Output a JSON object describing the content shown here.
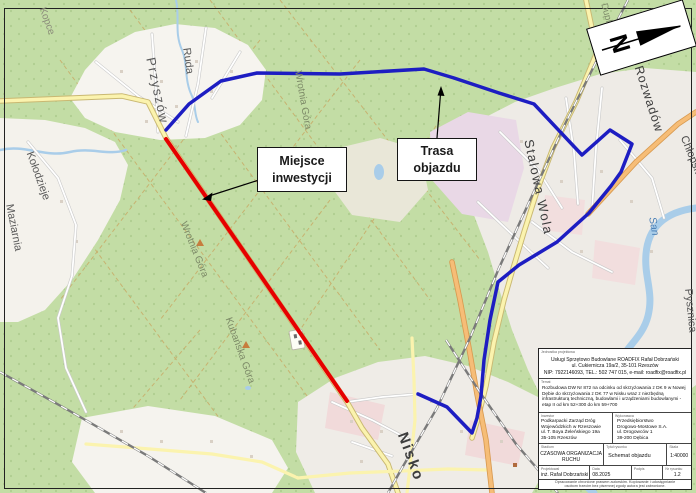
{
  "colors": {
    "investment_line": "#e60000",
    "detour_line": "#1d1dc2",
    "forest": "#c3dda5",
    "water": "#a9cde9",
    "road_yellow": "#fbf3ae",
    "road_orange": "#f6bd77",
    "callout_border": "#151515"
  },
  "callouts": {
    "investment_label": "Miejsce inwestycji",
    "detour_label": "Trasa objazdu"
  },
  "compass": {
    "north_letter": "N"
  },
  "map_labels": [
    {
      "name": "przyszow",
      "text": "Przyszów"
    },
    {
      "name": "ruda",
      "text": "Ruda"
    },
    {
      "name": "kopce",
      "text": "Kopce"
    },
    {
      "name": "kolodzieje",
      "text": "Kołodzieje"
    },
    {
      "name": "maziarnia",
      "text": "Maziarnia"
    },
    {
      "name": "wrotnia-gora-north",
      "text": "Wrotnia Góra"
    },
    {
      "name": "wrotnia-gora",
      "text": "Wrotnia Góra"
    },
    {
      "name": "kubanska-gora",
      "text": "Kubańska Góra"
    },
    {
      "name": "stalowa-wola",
      "text": "Stalowa Wola"
    },
    {
      "name": "rozwadow",
      "text": "Rozwadów"
    },
    {
      "name": "chlopska-wola",
      "text": "Chłopska Wola"
    },
    {
      "name": "pysznica",
      "text": "Pysznica"
    },
    {
      "name": "nisko",
      "text": "Nisko"
    },
    {
      "name": "san-river",
      "text": "San"
    },
    {
      "name": "dupla-gora",
      "text": "Dupla Góra"
    }
  ],
  "title_block": {
    "designer_unit": {
      "label": "Jednostka projektowa",
      "line1": "Usługi Sprzętowo Budowlane ROADFIX Rafał Dobrzański",
      "line2": "ul. Cukiernicza 19a/2, 35-101 Rzeszów",
      "line3": "NIP: 7922146093, TEL.: 502 747 015, e-mail: roadfix@roadfix.pl"
    },
    "subject": {
      "label": "Temat",
      "text": "Rozbudowa DW Nr 872 na odcinku od skrzyżowania z DK 9 w Nowej Dębie do skrzyżowania z DK 77 w Nisku wraz z niezbędną infrastrukturą techniczną, budowlami i urządzeniami budowlanymi - etap II od km 52+300 do km 59+700"
    },
    "investor": {
      "label": "Inwestor",
      "line1": "Podkarpacki Zarząd Dróg",
      "line2": "Wojewódzkich w Rzeszowie",
      "line3": "ul. T. Boya Żeleńskiego 19a",
      "line4": "35-105 Rzeszów"
    },
    "contractor": {
      "label": "Wykonawca",
      "line1": "Przedsiębiorstwo",
      "line2": "Drogowo-Mostowe S.A.",
      "line3": "ul. Drogowców 1",
      "line4": "39-200 Dębica"
    },
    "stage": {
      "label": "Stadium",
      "value": "CZASOWA ORGANIZACJA RUCHU"
    },
    "drawing_title": {
      "label": "Tytuł rysunku",
      "value": "Schemat objazdu"
    },
    "scale": {
      "label": "Skala",
      "value": "1:40000"
    },
    "designed_by": {
      "label": "Projektował",
      "value": "inż. Rafał Dobrzański"
    },
    "date": {
      "label": "Data",
      "value": "08.2025"
    },
    "signature": {
      "label": "Podpis",
      "value": ""
    },
    "drawing_no": {
      "label": "Nr rysunku",
      "value": "1.2"
    },
    "note": "Opracowanie chronione prawem autorskim. Kopiowanie i udostępnianie osobom trzecim bez pisemnej zgody autora jest zabronione."
  }
}
